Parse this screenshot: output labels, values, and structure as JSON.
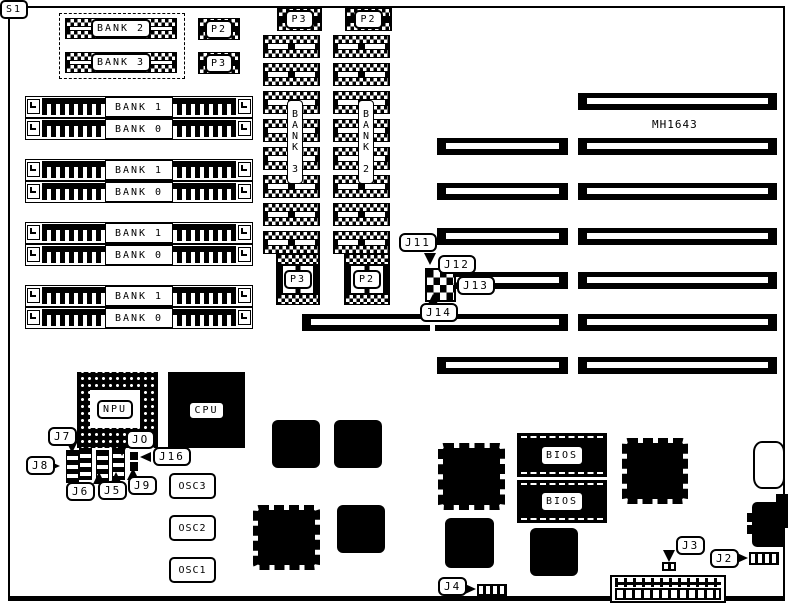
{
  "diagram": {
    "board_model": "MH1643",
    "top_left_group": {
      "chips": [
        "BANK 2",
        "BANK 3"
      ],
      "side_chips": [
        "P2",
        "P3"
      ]
    },
    "simm_groups": [
      {
        "slots": [
          "BANK 1",
          "BANK 0"
        ]
      },
      {
        "slots": [
          "BANK 1",
          "BANK 0"
        ]
      },
      {
        "slots": [
          "BANK 1",
          "BANK 0"
        ]
      },
      {
        "slots": [
          "BANK 1",
          "BANK 0"
        ]
      }
    ],
    "memory_columns": {
      "left": {
        "top_chip": "P3",
        "bank_label": "BANK 3",
        "bottom_chip": "P3"
      },
      "right": {
        "top_chip": "P2",
        "bank_label": "BANK 2",
        "bottom_chip": "P2"
      }
    },
    "slot_s1": "S1",
    "chips": {
      "npu": "NPU",
      "cpu": "CPU",
      "bios_top": "BIOS",
      "bios_bottom": "BIOS"
    },
    "oscillators": [
      "OSC3",
      "OSC2",
      "OSC1"
    ],
    "jumpers": {
      "j11": "J11",
      "j12": "J12",
      "j13": "J13",
      "j14": "J14",
      "j7": "J7",
      "j8": "J8",
      "j6": "J6",
      "j5": "J5",
      "j9": "J9",
      "j0": "JO",
      "j16": "J16",
      "j3": "J3",
      "j2": "J2",
      "j4": "J4"
    }
  }
}
